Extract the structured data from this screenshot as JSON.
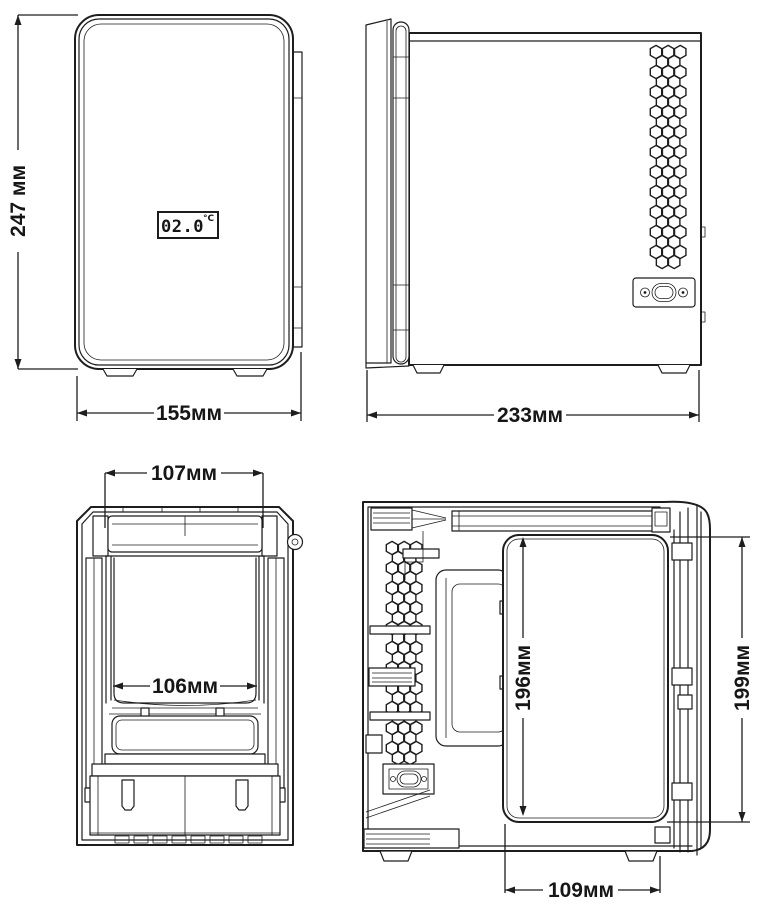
{
  "figure": {
    "background": "#ffffff",
    "line_color": "#1d1d1d"
  },
  "front_view": {
    "display_value": "02.0",
    "display_unit": "°C",
    "height_label": "247 мм",
    "width_label": "155мм"
  },
  "side_view": {
    "depth_label": "233мм"
  },
  "front_section": {
    "opening_width_label": "107мм",
    "cavity_width_label": "106мм"
  },
  "side_section": {
    "cavity_height_label": "196мм",
    "door_height_label": "199мм",
    "cavity_depth_label": "109мм"
  }
}
